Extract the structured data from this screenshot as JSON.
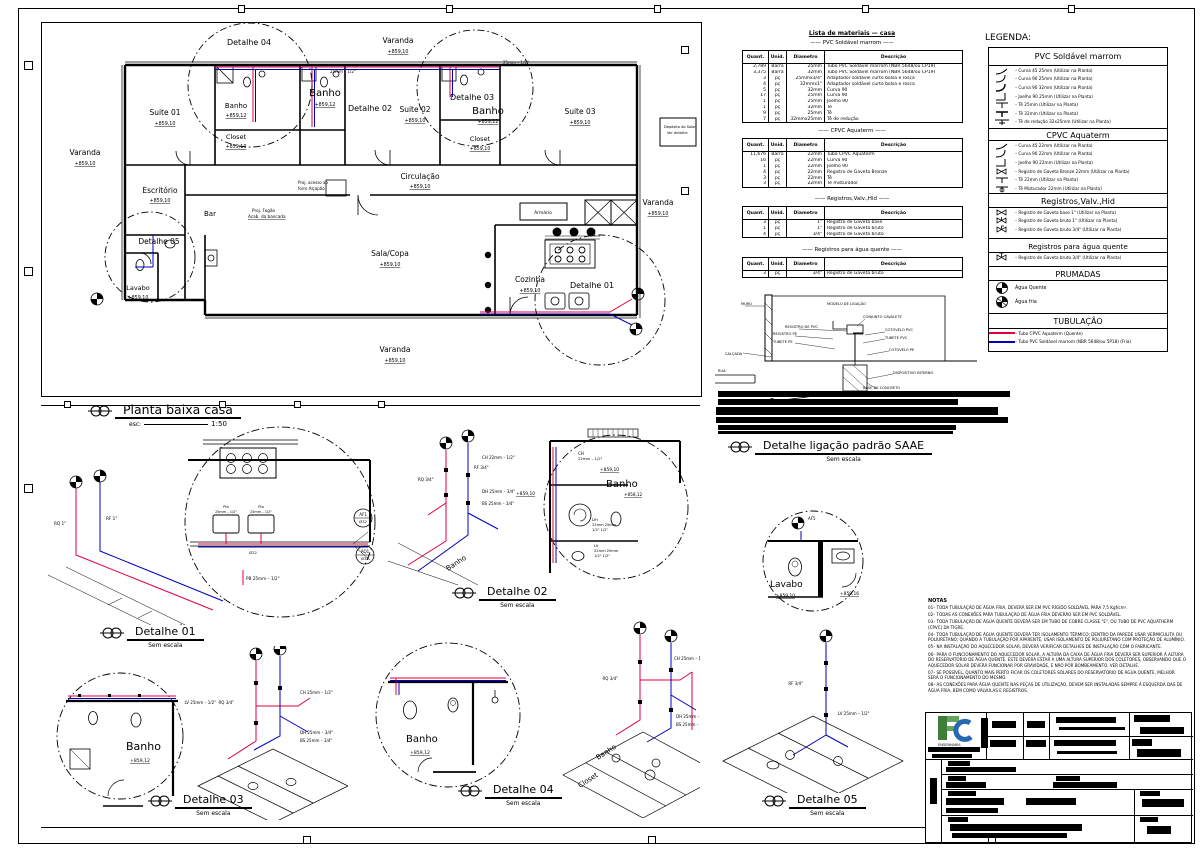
{
  "plan": {
    "title": "Planta baixa casa",
    "esc_label": "esc:",
    "esc_value": "1:50",
    "rooms": {
      "varanda_left": {
        "name": "Varanda",
        "level": "+859,10"
      },
      "varanda_top": {
        "name": "Varanda",
        "level": "+859,10"
      },
      "varanda_right": {
        "name": "Varanda",
        "level": "+859,10"
      },
      "varanda_bottom": {
        "name": "Varanda",
        "level": "+859,10"
      },
      "suite01": {
        "name": "Suite 01",
        "level": "+859,10"
      },
      "banho01": {
        "name": "Banho",
        "level": "+859,12"
      },
      "closet01": {
        "name": "Closet",
        "level": "+859,10"
      },
      "banho02": {
        "name": "Banho",
        "level": "+859,12"
      },
      "suite02": {
        "name": "Suite 02",
        "level": "+859,10"
      },
      "banho03": {
        "name": "Banho",
        "level": "+859,12"
      },
      "closet02": {
        "name": "Closet",
        "level": "+859,10"
      },
      "suite03": {
        "name": "Suite 03",
        "level": "+859,10"
      },
      "circulacao": {
        "name": "Circulação",
        "level": "+859,10"
      },
      "escritorio": {
        "name": "Escritório",
        "level": "+859,10"
      },
      "bar": {
        "name": "Bar"
      },
      "lavabo": {
        "name": "Lavabo",
        "level": "+859,10"
      },
      "sala_copa": {
        "name": "Sala/Copa",
        "level": "+859,10"
      },
      "cozinha": {
        "name": "Cozinha",
        "level": "+859,10"
      },
      "armario": {
        "name": "Armário"
      }
    },
    "annotations": {
      "proj_fogao": "Proj. Fogão",
      "acab_bancada": "Acab. da bancada",
      "alcapao1": "Proj. acesso ao",
      "alcapao2": "forro  Alçapão",
      "deposito1": "Depósito do Solar",
      "deposito2": "Ver detalhe",
      "pipe1": "25mm – 1/2\"",
      "pipe2": "25mm – 1/2\""
    }
  },
  "details": [
    {
      "title": "Detalhe 01",
      "scale": "Sem escala"
    },
    {
      "title": "Detalhe 02",
      "scale": "Sem escala"
    },
    {
      "title": "Detalhe 03",
      "scale": "Sem escala"
    },
    {
      "title": "Detalhe 04",
      "scale": "Sem escala"
    },
    {
      "title": "Detalhe 05",
      "scale": "Sem escala"
    }
  ],
  "d1": {
    "iso": {
      "rq": "RQ 1\"",
      "rf": "RF 1\"",
      "pb": "PB 25mm – 1/2\""
    },
    "circle": {
      "pia1a": "Pia",
      "pia1b": "25mm – 1/2\"",
      "pia2a": "Pia",
      "pia2b": "25mm – 1/2\"",
      "dia": "Ø22",
      "af": "AF1",
      "af2": "Ø32",
      "aq": "AQ1",
      "aq2": "Ø32"
    }
  },
  "d2": {
    "iso": {
      "rq": "RQ 3/4\"",
      "rf": "RF 3/4\"",
      "ch": "CH 22mm – 1/2\"",
      "dh": "DH 25mm – 3/4\"",
      "bs": "BS 25mm – 3/4\"",
      "room": "Banho"
    },
    "circle": {
      "ch1": "CH",
      "ch2": "22mm – 1/2\"",
      "lvl1": "+859,10",
      "room": "Banho",
      "lvl2": "+858,12",
      "lvl3": "+859,10",
      "dh1": "DH",
      "dh2": "22mm 25mm",
      "dh3": "1/2\"  1/2\"",
      "lv1": "LV",
      "lv2": "22mm 25mm",
      "lv3": "1/2\"  1/2\""
    }
  },
  "d3": {
    "circle": {
      "room": "Banho",
      "lvl": "+859,12"
    },
    "iso": {
      "rq": "RQ 3/4\"",
      "ch": "CH 25mm – 1/2\"",
      "dh": "DH 25mm – 3/4\"",
      "bs": "BS 25mm – 3/4\"",
      "lv": "LV 25mm – 1/2\""
    }
  },
  "d4": {
    "circle": {
      "room": "Banho",
      "lvl": "+859,12"
    },
    "iso": {
      "rq": "RQ 3/4\"",
      "ch": "CH 25mm – 1/2\"",
      "dh": "DH 25mm – 3/4\"",
      "bs": "BS 25mm – 3/4\"",
      "room1": "Banho",
      "room2": "Closet"
    }
  },
  "d5": {
    "circle": {
      "room": "Lavabo",
      "lvl1": "+859,10",
      "lvl2": "+859,16",
      "af": "AF5"
    },
    "iso": {
      "rf": "RF 3/4\"",
      "lv": "LV 25mm – 1/2\""
    }
  },
  "materials": {
    "title": "Lista de materiais — casa",
    "headers": [
      "Quant.",
      "Unid.",
      "Diametro",
      "Descrição"
    ],
    "sections": [
      {
        "title": "—— PVC Soldável marrom ——",
        "rows": [
          [
            "2,789",
            "Barra",
            "25mm",
            "Tubo PVC Soldável marrom (NBR 5648/ou CP19)"
          ],
          [
            "3,375",
            "Barra",
            "32mm",
            "Tubo PVC Soldável marrom (NBR 5648/ou CP19)"
          ],
          [
            "3",
            "pç",
            "25mmx3/4\"",
            "Adaptador soldável curto bolsa e rosca"
          ],
          [
            "4",
            "pç",
            "32mmx1\"",
            "Adaptador soldável curto bolsa e rosca"
          ],
          [
            "5",
            "pç",
            "32mm",
            "Curva 90"
          ],
          [
            "17",
            "pç",
            "25mm",
            "Curva 90"
          ],
          [
            "1",
            "pç",
            "25mm",
            "Joelho 90"
          ],
          [
            "1",
            "pç",
            "32mm",
            "Tê"
          ],
          [
            "9",
            "pç",
            "25mm",
            "Tê"
          ],
          [
            "7",
            "pç",
            "32mmx25mm",
            "Tê de redução"
          ]
        ]
      },
      {
        "title": "—— CPVC Aquaterm ——",
        "rows": [
          [
            "11,676",
            "Barra",
            "22mm",
            "Tubo CPVC Aquaterm"
          ],
          [
            "16",
            "pç",
            "22mm",
            "Curva 90"
          ],
          [
            "1",
            "pç",
            "22mm",
            "Joelho 90"
          ],
          [
            "4",
            "pç",
            "22mm",
            "Registro de Gaveta Bronze"
          ],
          [
            "3",
            "pç",
            "22mm",
            "Tê"
          ],
          [
            "3",
            "pç",
            "22mm",
            "Tê misturador"
          ]
        ]
      },
      {
        "title": "—— Registros,Valv.,Hid ——",
        "rows": [
          [
            "3",
            "pç",
            "1\"",
            "Registro de Gaveta base"
          ],
          [
            "1",
            "pç",
            "1\"",
            "Registro de Gaveta bruto"
          ],
          [
            "4",
            "pç",
            "3/4\"",
            "Registro de Gaveta bruto"
          ]
        ]
      },
      {
        "title": "—— Registros para água quente ——",
        "rows": [
          [
            "3",
            "pç",
            "3/4\"",
            "Registro de Gaveta bruto"
          ]
        ]
      }
    ]
  },
  "legend": {
    "title": "LEGENDA:",
    "sec_pvc": "PVC Soldável marrom",
    "pvc": [
      "– Curva 45 25mm (Utilizar na Planta)",
      "– Curva 90 25mm (Utilizar na Planta)",
      "– Curva 90 32mm (Utilizar na Planta)",
      "– Joelho 90 25mm (Utilizar na Planta)",
      "– Tê 25mm (Utilizar na Planta)",
      "– Tê 32mm (Utilizar na Planta)",
      "– Tê de redução 32x25mm (Utilizar na Planta)"
    ],
    "sec_cpvc": "CPVC Aquaterm",
    "cpvc": [
      "– Curva 45 22mm (Utilizar na Planta)",
      "– Curva 90 22mm (Utilizar na Planta)",
      "– Joelho 90 22mm (Utilizar na Planta)",
      "– Registro de Gaveta Bronze 22mm (Utilizar na Planta)",
      "– Tê 22mm (Utilizar na Planta)",
      "– Tê Misturador 22mm (Utilizar na Planta)"
    ],
    "sec_reg": "Registros,Valv.,Hid",
    "reg": [
      "– Registro de Gaveta base 1\" (Utilizar na Planta)",
      "– Registro de Gaveta bruto 1\" (Utilizar na Planta)",
      "– Registro de Gaveta bruto 3/4\" (Utilizar na Planta)"
    ],
    "sec_regaq": "Registros para água quente",
    "regaq": [
      "– Registro de Gaveta bruto 3/4\" (Utilizar na Planta)"
    ],
    "sec_prumadas": "PRUMADAS",
    "prumadas": [
      "Água Quente",
      "Água fria"
    ],
    "sec_tub": "TUBULAÇÃO",
    "tub": [
      "– Tubo CPVC Aquaterm (Quente)",
      "– Tubo PVC Soldável marrom (NBR 5648/ou 5P18) (Fria)"
    ]
  },
  "saae": {
    "title": "Detalhe ligação padrão SAAE",
    "scale": "Sem escala",
    "labels": [
      "MURO",
      "CALÇADA",
      "RUA",
      "REGISTRO DE PVC",
      "MODELO DE LIGAÇÃO",
      "CONJUNTO CAVALETE",
      "COTOVELO PVC",
      "TUBETE PVC",
      "TUBETE PE",
      "COTOVELO PE",
      "REGISTRO PE",
      "DISPOSITIVO INTERNO",
      "BASE DE CONCRETO"
    ]
  },
  "notes": {
    "title": "NOTAS",
    "items": [
      "01– TODA TUBULAÇÃO DE ÁGUA FRIA, DEVERÁ SER EM PVC RÍGIDO SOLDÁVEL PARA 7,5 Kgf/cm².",
      "02– TODAS AS CONEXÕES PARA TUBULAÇÃO DE ÁGUA FRIA DEVERÃO SER EM PVC SOLDÁVEL.",
      "03– TODA TUBULAÇÃO DE ÁGUA QUENTE DEVERÁ SER EM TUBO DE COBRE CLASSE \"E\", OU TUBO DE PVC AQUATHERM (CPVC) DA TIGRE.",
      "04– TODA TUBULAÇÃO DE ÁGUA QUENTE DEVERÁ TER ISOLAMENTO TÉRMICO; DENTRO DA PAREDE USAR VERMICULITA OU POLIURETANO; QUANDO A TUBULAÇÃO FOR APARENTE, USAR ISOLAMENTO DE POLIURETANO COM PROTEÇÃO DE ALUMÍNIO.",
      "05– NA INSTALAÇÃO DO AQUECEDOR SOLAR, DEVERÁ VERIFICAR DETALHES DE INSTALAÇÃO COM O FABRICANTE.",
      "06– PARA O FUNCIONAMENTO DO AQUECEDOR SOLAR, A ALTURA DA CAIXA DE ÁGUA FRIA DEVERÁ SER SUPERIOR À ALTURA DO RESERVATÓRIO DE ÁGUA QUENTE. ESTE DEVERÁ ESTAR A UMA ALTURA SUPERIOR DOS COLETORES, OBSERVANDO QUE O AQUECEDOR SOLAR DEVERÁ FUNCIONAR POR GRAVIDADE, E NÃO POR BOMBEAMENTO. VER DETALHE.",
      "07– SE POSSÍVEL, QUANTO MAIS PERTO FICAR OS COLETORES SOLARES DO RESERVATÓRIO DE ÁGUA QUENTE, MELHOR SERÁ O FUNCIONAMENTO DO MESMO.",
      "08– AS CONEXÕES PARA ÁGUA QUENTE NAS PEÇAS DE UTILIZAÇÃO, DEVEM SER INSTALADAS SEMPRE À ESQUERDA DAS DE ÁGUA FRIA, BEM COMO VÁLVULAS E REGISTROS."
    ]
  },
  "titleblock": {
    "company_sub": "ENGENHARIA"
  }
}
